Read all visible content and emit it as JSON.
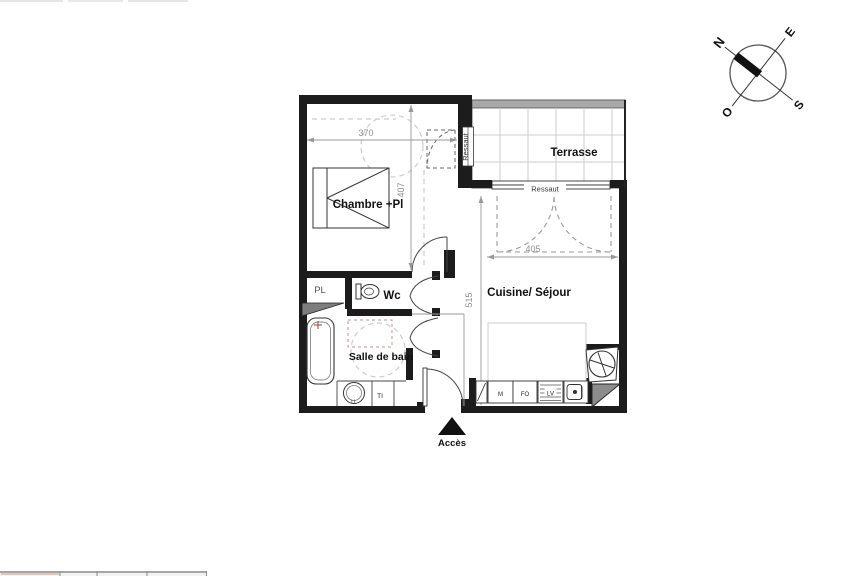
{
  "page": {
    "background": "#ffffff"
  },
  "compass": {
    "n": "N",
    "e": "E",
    "s": "S",
    "o": "O"
  },
  "plan": {
    "rooms": {
      "chambre": {
        "label": "Chambre +Pl"
      },
      "terrasse": {
        "label": "Terrasse"
      },
      "wc": {
        "label": "Wc"
      },
      "pl": {
        "label": "PL"
      },
      "salle_de_bain": {
        "label": "Salle de bain"
      },
      "cuisine_sejour": {
        "label": "Cuisine/ Séjour"
      }
    },
    "thresholds": {
      "terrace_door": "Ressaut",
      "terrace_window": "Ressaut"
    },
    "entry": {
      "label": "Accès"
    },
    "dimensions": {
      "chambre_width": "370",
      "chambre_height": "407",
      "cuisine_width": "405",
      "cuisine_height": "515"
    },
    "appliances": {
      "microwave": "M",
      "oven": "FO",
      "dishwasher": "LV",
      "washer": "LL",
      "towel_rail": "TI"
    },
    "colors": {
      "wall": "#1c1c1c",
      "line": "#444444",
      "grid": "#cccccc",
      "dash": "#cccccc",
      "accent_dash": "#cc8f8f",
      "gray_fill": "#8c8c8c"
    }
  }
}
